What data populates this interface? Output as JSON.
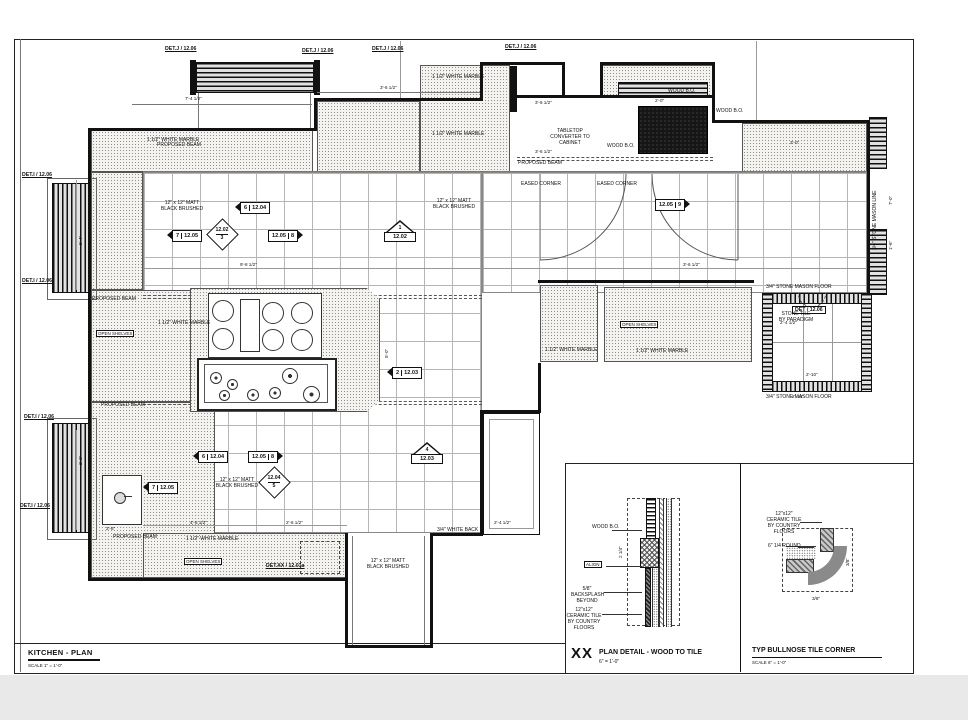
{
  "sheet": {
    "title": "KITCHEN - PLAN",
    "scale": "SCALE 1\" = 1'-0\""
  },
  "callouts": {
    "top": [
      "DET.J / 12.06",
      "DET.J / 12.06",
      "DET.J / 12.06",
      "DET.J / 12.06"
    ],
    "left": [
      "DET.I / 12.06",
      "DET.I / 12.06",
      "DET.I / 12.06",
      "DET.I / 12.06"
    ],
    "xx": "DET.XX / 12.01a",
    "room": "DET / 12.06"
  },
  "markers": [
    {
      "num": "6",
      "sheet": "12.04"
    },
    {
      "num": "7",
      "sheet": "12.05"
    },
    {
      "num": "3",
      "sheet": "12.02"
    },
    {
      "num": "8",
      "sheet": "12.05"
    },
    {
      "num": "1",
      "sheet": "12.02"
    },
    {
      "num": "9",
      "sheet": "12.05"
    },
    {
      "num": "2",
      "sheet": "12.03"
    },
    {
      "num": "6",
      "sheet": "12.04"
    },
    {
      "num": "8",
      "sheet": "12.05"
    },
    {
      "num": "4",
      "sheet": "12.03"
    },
    {
      "num": "7",
      "sheet": "12.05"
    },
    {
      "num": "5",
      "sheet": "12.04"
    }
  ],
  "notes": [
    "1 1/2\" WHITE MARBLE",
    "1 1/2\" WHITE MARBLE",
    "1 1/2\" WHITE MARBLE",
    "1 1/2\" WHITE MARBLE",
    "1 1/2\" WHITE MARBLE",
    "1 1/2\" WHITE MARBLE",
    "1 1/2\" WHITE MARBLE",
    "12\" x 12\" MATT BLACK BRUSHED",
    "12\" x 12\" MATT BLACK BRUSHED",
    "12\" x 12\" MATT BLACK BRUSHED",
    "12\" x 12\" MATT BLACK BRUSHED",
    "WOOD B.O.",
    "WOOD B.O.",
    "WOOD B.O.",
    "PROPOSED BEAM",
    "PROPOSED BEAM",
    "PROPOSED BEAM",
    "PROPOSED BEAM",
    "PROPOSED BEAM",
    "EASED CORNER",
    "EASED CORNER",
    "TABLETOP CONVERTER TO CABINET",
    "3/4\" STONE MASON FLOOR",
    "3/4\" STONE MASON FLOOR",
    "STONE TILE BY PARADIGM",
    "3/4\" STONE MASON LINE",
    "3/4\" WHITE BACK",
    "OPEN SHELVES",
    "OPEN SHELVES",
    "OPEN SHELVES"
  ],
  "dims": [
    "7'-4 1/2\"",
    "3'-6 1/2\"",
    "3'-6 1/2\"",
    "3'-6 1/2\"",
    "2'-0\"",
    "3'-0\"",
    "2'-4 1/2\"",
    "2'-10\"",
    "7'-0\"",
    "1'-6\"",
    "4'-6 1/2\"",
    "2'-6 1/2\"",
    "2'-4 1/2\"",
    "9'-8 1/2\"",
    "3'-6 1/2\"",
    "2'-10\"",
    "2'-6\"",
    "5'-0\"",
    "2 1/4\"",
    "3/8\"",
    "3/8\"",
    "5'-4\"",
    "2'-0\""
  ],
  "details": {
    "wood_to_tile": {
      "id": "XX",
      "title": "PLAN DETAIL - WOOD TO TILE",
      "scale": "6\" = 1'-0\"",
      "labels": {
        "wood_bo": "WOOD B.O.",
        "align": "ALIGN",
        "backsplash": "5/8\" BACKSPLASH BEYOND",
        "tile": "12\"x12\" CERAMIC TILE BY COUNTRY FLOORS"
      }
    },
    "bullnose": {
      "title": "TYP BULLNOSE TILE CORNER",
      "scale": "SCALE 6\" = 1'-0\"",
      "labels": {
        "tile": "12\"x12\" CERAMIC TILE BY COUNTRY FLOORS",
        "quarter_round": "6\" 1/4 ROUND"
      }
    }
  }
}
